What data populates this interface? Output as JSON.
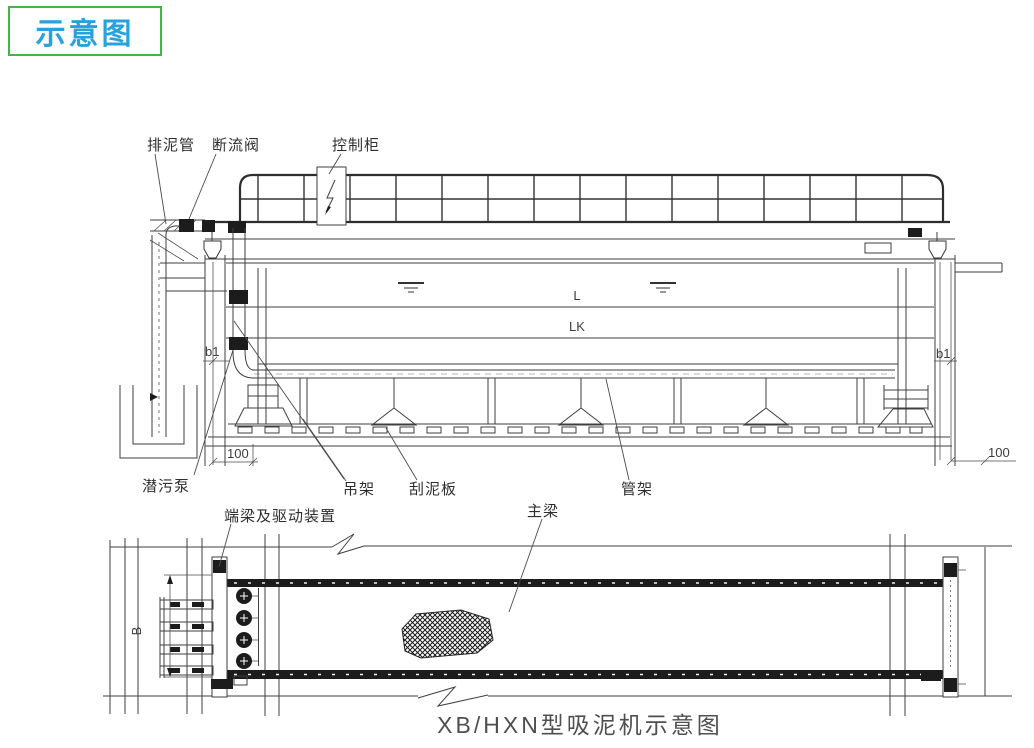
{
  "badge": {
    "label": "示意图"
  },
  "title": "XB/HXN型吸泥机示意图",
  "labels": {
    "drain_pipe": "排泥管",
    "shutoff_valve": "断流阀",
    "control_cabinet": "控制柜",
    "submersible_pump": "潜污泵",
    "hanger_bracket": "吊架",
    "scraper_plate": "刮泥板",
    "pipe_rack": "管架",
    "end_beam_drive": "端梁及驱动装置",
    "main_beam": "主梁"
  },
  "dimensions": {
    "length": "L",
    "length_k": "LK",
    "b1_left": "b1",
    "b1_right": "b1",
    "offset_left": "100",
    "offset_right": "100",
    "width_b": "B"
  },
  "colors": {
    "badge_border": "#44b549",
    "badge_text": "#28a2dc",
    "line": "#3f3f3f",
    "title_text": "#4f4f4f"
  }
}
